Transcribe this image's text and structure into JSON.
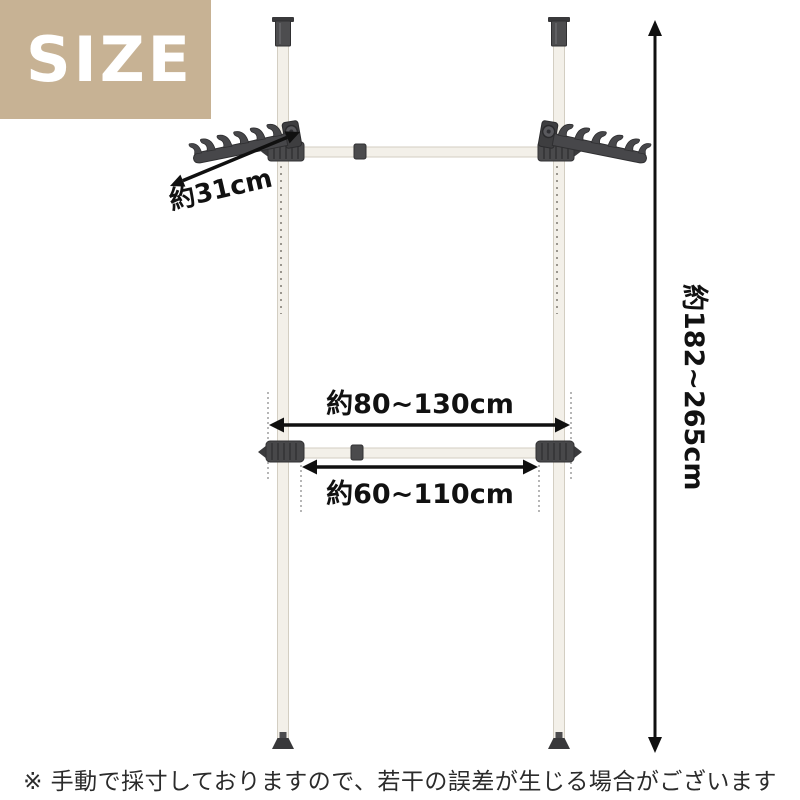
{
  "badge": {
    "label": "SIZE"
  },
  "dims": {
    "arm": "約31cm",
    "upper": "約80~130cm",
    "lower": "約60~110cm",
    "height": "約182~265cm"
  },
  "note": {
    "text": "※ 手動で採寸しておりますので、若干の誤差が生じる場合がございます"
  },
  "colors": {
    "badge_bg": "#c7b294",
    "badge_text": "#ffffff",
    "pole_fill": "#f3f0e9",
    "pole_outline": "#d3cec2",
    "hardware_dark": "#47474a",
    "arrow_black": "#101010",
    "note_text": "#2b2b2b"
  }
}
